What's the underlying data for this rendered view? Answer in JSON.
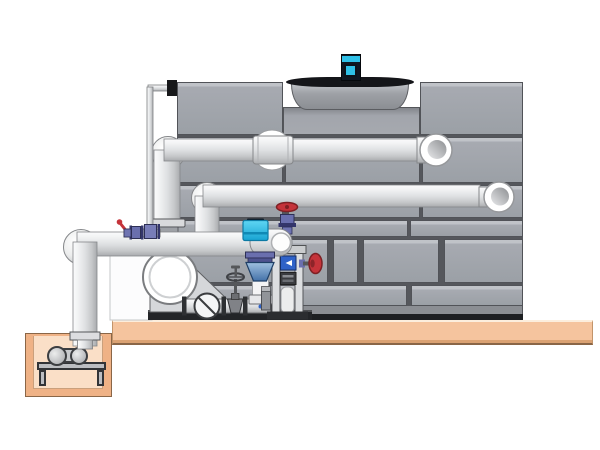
{
  "scene": {
    "type": "technical-illustration",
    "subject": "cooling-tower-piping-installation",
    "canvas": {
      "width": 600,
      "height": 450
    },
    "colors": {
      "page-bg": "#ffffff",
      "panel-fill": "#9ba0a6",
      "panel-border": "#515358",
      "panel-seam": "#55575c",
      "pipe-outline": "#85878a",
      "cowl-dark": "#141519",
      "motor-navy": "#101722",
      "cyan-accent": "#2fc1e8",
      "valve-red": "#c5333a",
      "valve-purple": "#6a6fae",
      "diffuser-blue": "#4a7fb5",
      "meter-blue": "#2f62c8",
      "slab-tan": "#f5c49e",
      "pit-orange": "#efb286",
      "pit-interior": "#fadfc7",
      "skid-dark": "#232528"
    },
    "components": [
      "fan-motor",
      "fan-shroud",
      "tower-casing-panels",
      "hot-water-supply-pipe",
      "return-water-pipe",
      "makeup-water-line",
      "pump-suction-header",
      "header-end-cap",
      "makeup-isolation-valves",
      "control-valve-actuator",
      "suction-diffuser",
      "circulation-pump",
      "check-valve",
      "gate-valve",
      "balancing-valve",
      "instrument-stand",
      "flow-meter",
      "drain-elbow",
      "equipment-skid",
      "concrete-slab",
      "sump-pit",
      "sump-pump",
      "sump-suction-pipe"
    ]
  }
}
